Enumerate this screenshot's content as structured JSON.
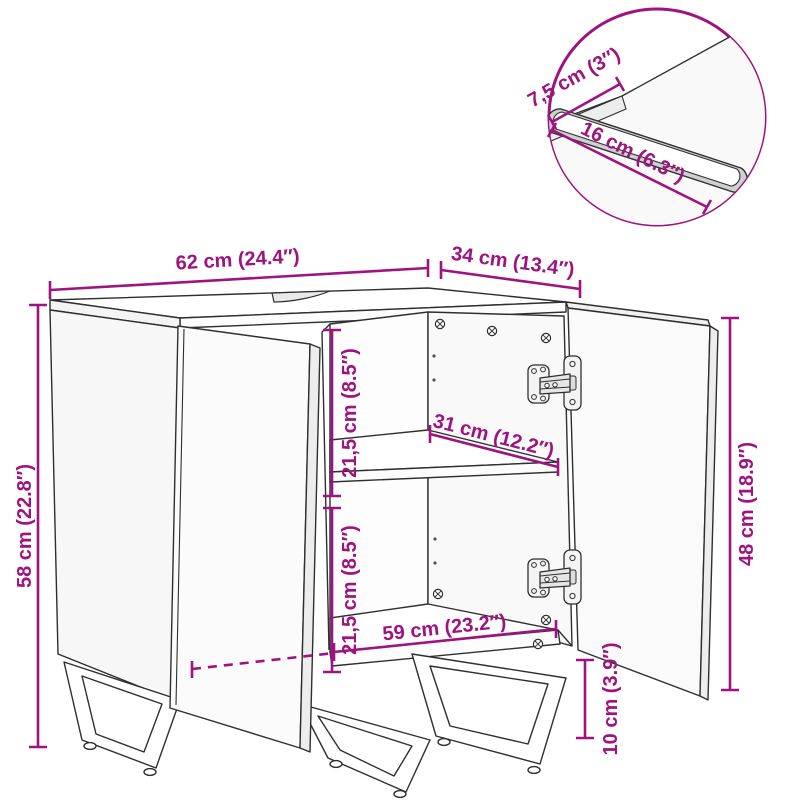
{
  "diagram": {
    "title": "Bathroom sink cabinet dimension drawing",
    "accent_color": "#9E1380",
    "line_color": "#2f2f2f",
    "unit_system": "cm with inch equivalents"
  },
  "dims": {
    "width": {
      "label": "62 cm (24.4″)"
    },
    "depth": {
      "label": "34 cm (13.4″)"
    },
    "height": {
      "label": "58 cm (22.8″)"
    },
    "upper_inner_height": {
      "label": "21,5 cm (8.5″)"
    },
    "shelf_depth": {
      "label": "31 cm (12.2″)"
    },
    "lower_inner_height": {
      "label": "21,5 cm (8.5″)"
    },
    "inner_width": {
      "label": "59 cm (23.2″)"
    },
    "door_height": {
      "label": "48 cm (18.9″)"
    },
    "leg_height": {
      "label": "10 cm (3.9″)"
    },
    "cutout_edge_offset": {
      "label": "7,5 cm (3″)"
    },
    "cutout_length": {
      "label": "16 cm (6.3″)"
    }
  }
}
